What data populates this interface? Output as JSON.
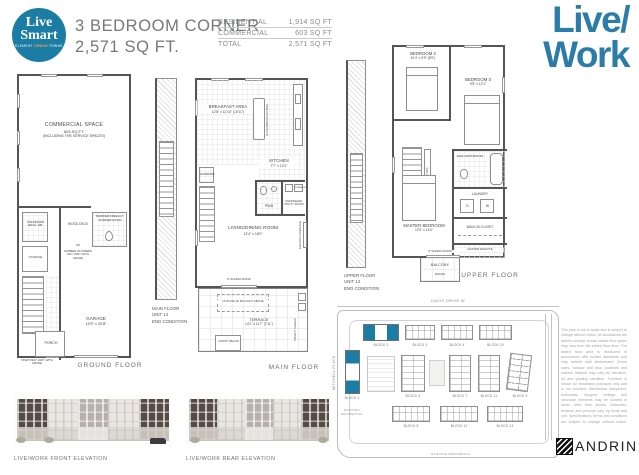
{
  "header": {
    "logo": {
      "word1": "Live",
      "word2": "Smart",
      "tagline": [
        "ELEMENT",
        "URBAN",
        "TOWNS"
      ]
    },
    "title": {
      "line1": "3 BEDROOM CORNER",
      "line2": "2,571 SQ FT."
    },
    "specs": [
      {
        "label": "RESIDENTIAL",
        "value": "1,914 SQ FT"
      },
      {
        "label": "COMMERCIAL",
        "value": "603 SQ FT"
      },
      {
        "label": "TOTAL",
        "value": "2,571 SQ FT"
      }
    ],
    "brand": {
      "line1": "Live/",
      "line2": "Work"
    }
  },
  "ground": {
    "commercial": "COMMERCIAL SPACE",
    "commercial_area": "603 SQ.FT.",
    "commercial_note": "(INCLUDING THE SERVICE SPACES)",
    "mech": "UNFINISHED MECH. RM.",
    "storage": "STORAGE",
    "wood_deck": "WOOD DECK",
    "up": "UP",
    "risers_note": "NUMBER OF RISERS MAY VARY WITH GRADE",
    "powder": "BARRIER-FREE ALT. POWDER ROOM",
    "garage": "GARAGE",
    "garage_dim": "10'9\" x 20'8\"",
    "porch": "PORCH",
    "entry_note": "STEPS MAY VARY WITH GRADE",
    "label": "GROUND FLOOR"
  },
  "main": {
    "fragment": [
      "MAIN FLOOR",
      "UNIT 12",
      "END CONDITION"
    ],
    "breakfast": "BREAKFAST AREA",
    "breakfast_dim": "12'8\" x 11'10\" (10'11\")",
    "kitchen": "KITCHEN",
    "kitchen_dim": "7'7\" x 13'1\"",
    "island": "FLUSH BREAKFAST BAR",
    "wardrobe": "WARDROBE",
    "pwd": "PWD",
    "utility": "UNFINISHED UTILITY ROOM",
    "furnace": "FURNACE",
    "living": "LIVING/DINING ROOM",
    "living_dim": "13'4\" x 18'0\"",
    "fireplace": "ELECTRIC FIREPLACE",
    "sliding_door": "8' SLIDING DOOR",
    "balcony_outline": "OUTLINE OF BALCONY ABOVE",
    "terrace": "TERRACE",
    "terrace_dim": "14'1\" x 11'7\" (7'11\")",
    "canopy": "CANOPY BELOW",
    "privacy": "PRIVACY SCREEN",
    "label": "MAIN FLOOR"
  },
  "upper": {
    "fragment": [
      "UPPER FLOOR",
      "UNIT 12",
      "END CONDITION"
    ],
    "bed2": "BEDROOM 2",
    "bed2_dim": "10'4\" x 9'9\" (8'9\")",
    "bed3": "BEDROOM 3",
    "bed3_dim": "9'9\" x 12'1\"",
    "bath": "MAIN BATHROOM",
    "laundry": "LAUNDRY",
    "d": "D",
    "w": "W",
    "wic": "WALK-IN CLOSET",
    "linen": "LINEN",
    "master": "MASTER BEDROOM",
    "master_dim": "12'0\" x 14'0\"",
    "ensuite": "MASTER ENSUITE",
    "sliding_door": "8' SLIDING DOOR",
    "balcony": "BALCONY",
    "railing": "RAILING",
    "label": "UPPER FLOOR"
  },
  "elevations": {
    "front_caption": "LIVE/WORK FRONT ELEVATION",
    "rear_caption": "LIVE/WORK REAR ELEVATION"
  },
  "siteplan": {
    "street_top": "DAVIS DRIVE W",
    "street_left": "MITCHELL PLACE",
    "existing_left": "EXISTING RESIDENTIAL",
    "existing_bottom": "EXISTING RESIDENTIAL",
    "blocks": {
      "b1": "BLOCK 1",
      "b2": "BLOCK 2",
      "b3": "BLOCK 3",
      "b4": "BLOCK 4",
      "b10": "BLOCK 10",
      "b6": "BLOCK 6",
      "b7": "BLOCK 7",
      "b12": "BLOCK 12",
      "b9": "BLOCK 9",
      "b8": "BLOCK 8",
      "b11": "BLOCK 11",
      "b13": "BLOCK 13"
    },
    "disclaimer": "This plan is not to scale and is subject to change without notice. All illustrations are artist's concept. Actual usable floor space may vary from the stated floor area. The stated floor area is measured in accordance with builder standards and may include wall thicknesses. Room sizes, window and door locations and exterior finishes may vary by elevation, lot and grading condition. Furniture is shown for illustration purposes only and is not included. Mechanical equipment, bulkheads, dropped ceilings and structural elements may be located in areas other than shown. Balconies, terraces and porches vary by block and unit. Specifications, terms and conditions are subject to change without notice. Please see a sales representative for full details. E. & O. E.",
    "brand": "ANDRIN"
  },
  "colors": {
    "teal": "#1b7da4",
    "brand_blue": "#2b7ca8",
    "accent_gray": "#808285"
  }
}
